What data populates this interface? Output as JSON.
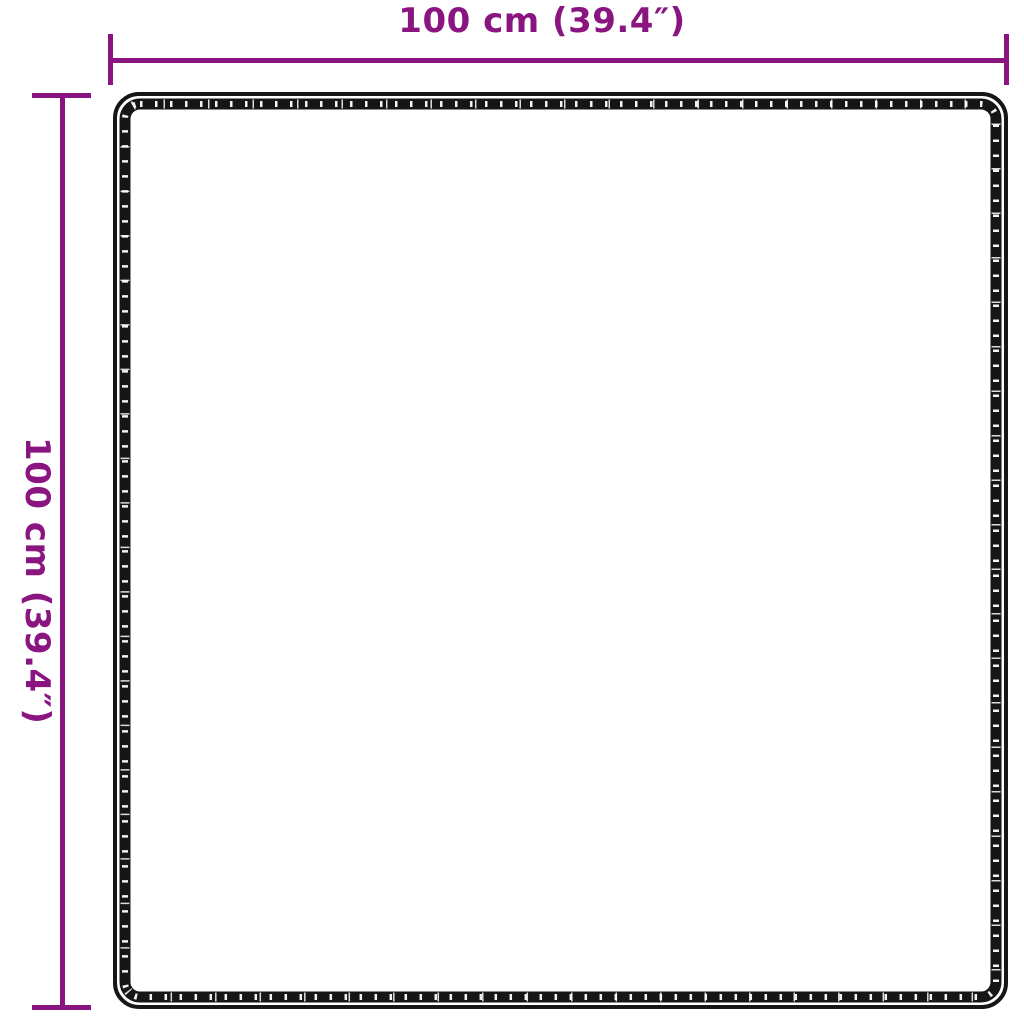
{
  "diagram": {
    "kind": "product-dimension-diagram",
    "subject": "square rug outline with stitched border, top view",
    "background_color": "#ffffff",
    "accent_color": "#8a1580",
    "outline_color": "#161616",
    "width_dimension": {
      "label": "100 cm (39.4″)",
      "value_cm": 100,
      "value_inches": 39.4
    },
    "height_dimension": {
      "label": "100 cm (39.4″)",
      "value_cm": 100,
      "value_inches": 39.4
    }
  }
}
